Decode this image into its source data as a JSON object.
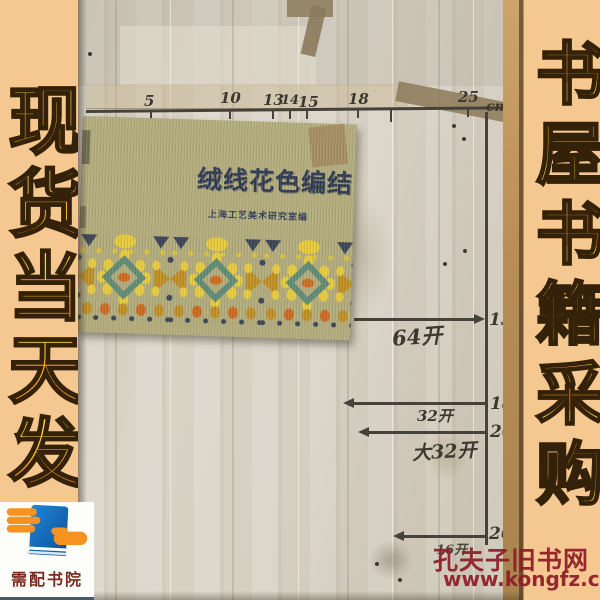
{
  "left_banner": {
    "text": "现货当天发"
  },
  "right_banner": {
    "text": "书屋书籍采购"
  },
  "logo": {
    "caption": "需配书院"
  },
  "watermark": {
    "site_name": "孔夫子旧书网",
    "site_url": "www.kongfz.com"
  },
  "photo": {
    "ruler": {
      "unit": "cm",
      "ticks": [
        "5",
        "10",
        "13",
        "14",
        "15",
        "18",
        "25"
      ]
    },
    "book": {
      "title": "绒线花色编结",
      "subtitle": "上海工艺美术研究室编"
    },
    "annotations": [
      {
        "value": "13",
        "format": "64开"
      },
      {
        "value": "18",
        "format": "32开"
      },
      {
        "value": "20",
        "format": "大32开"
      },
      {
        "value": "26",
        "format": "16开"
      }
    ]
  },
  "colors": {
    "banner_bg": "#f5c791",
    "banner_text_top": "#ffe04f",
    "banner_text_bottom": "#ef7d10",
    "watermark_red": "#8e1d26",
    "paper": "#d6d0c3",
    "book_cover": "#b3ad7e",
    "title_navy": "#2c3854",
    "logo_blue": "#1669b8",
    "logo_orange": "#f69220"
  }
}
